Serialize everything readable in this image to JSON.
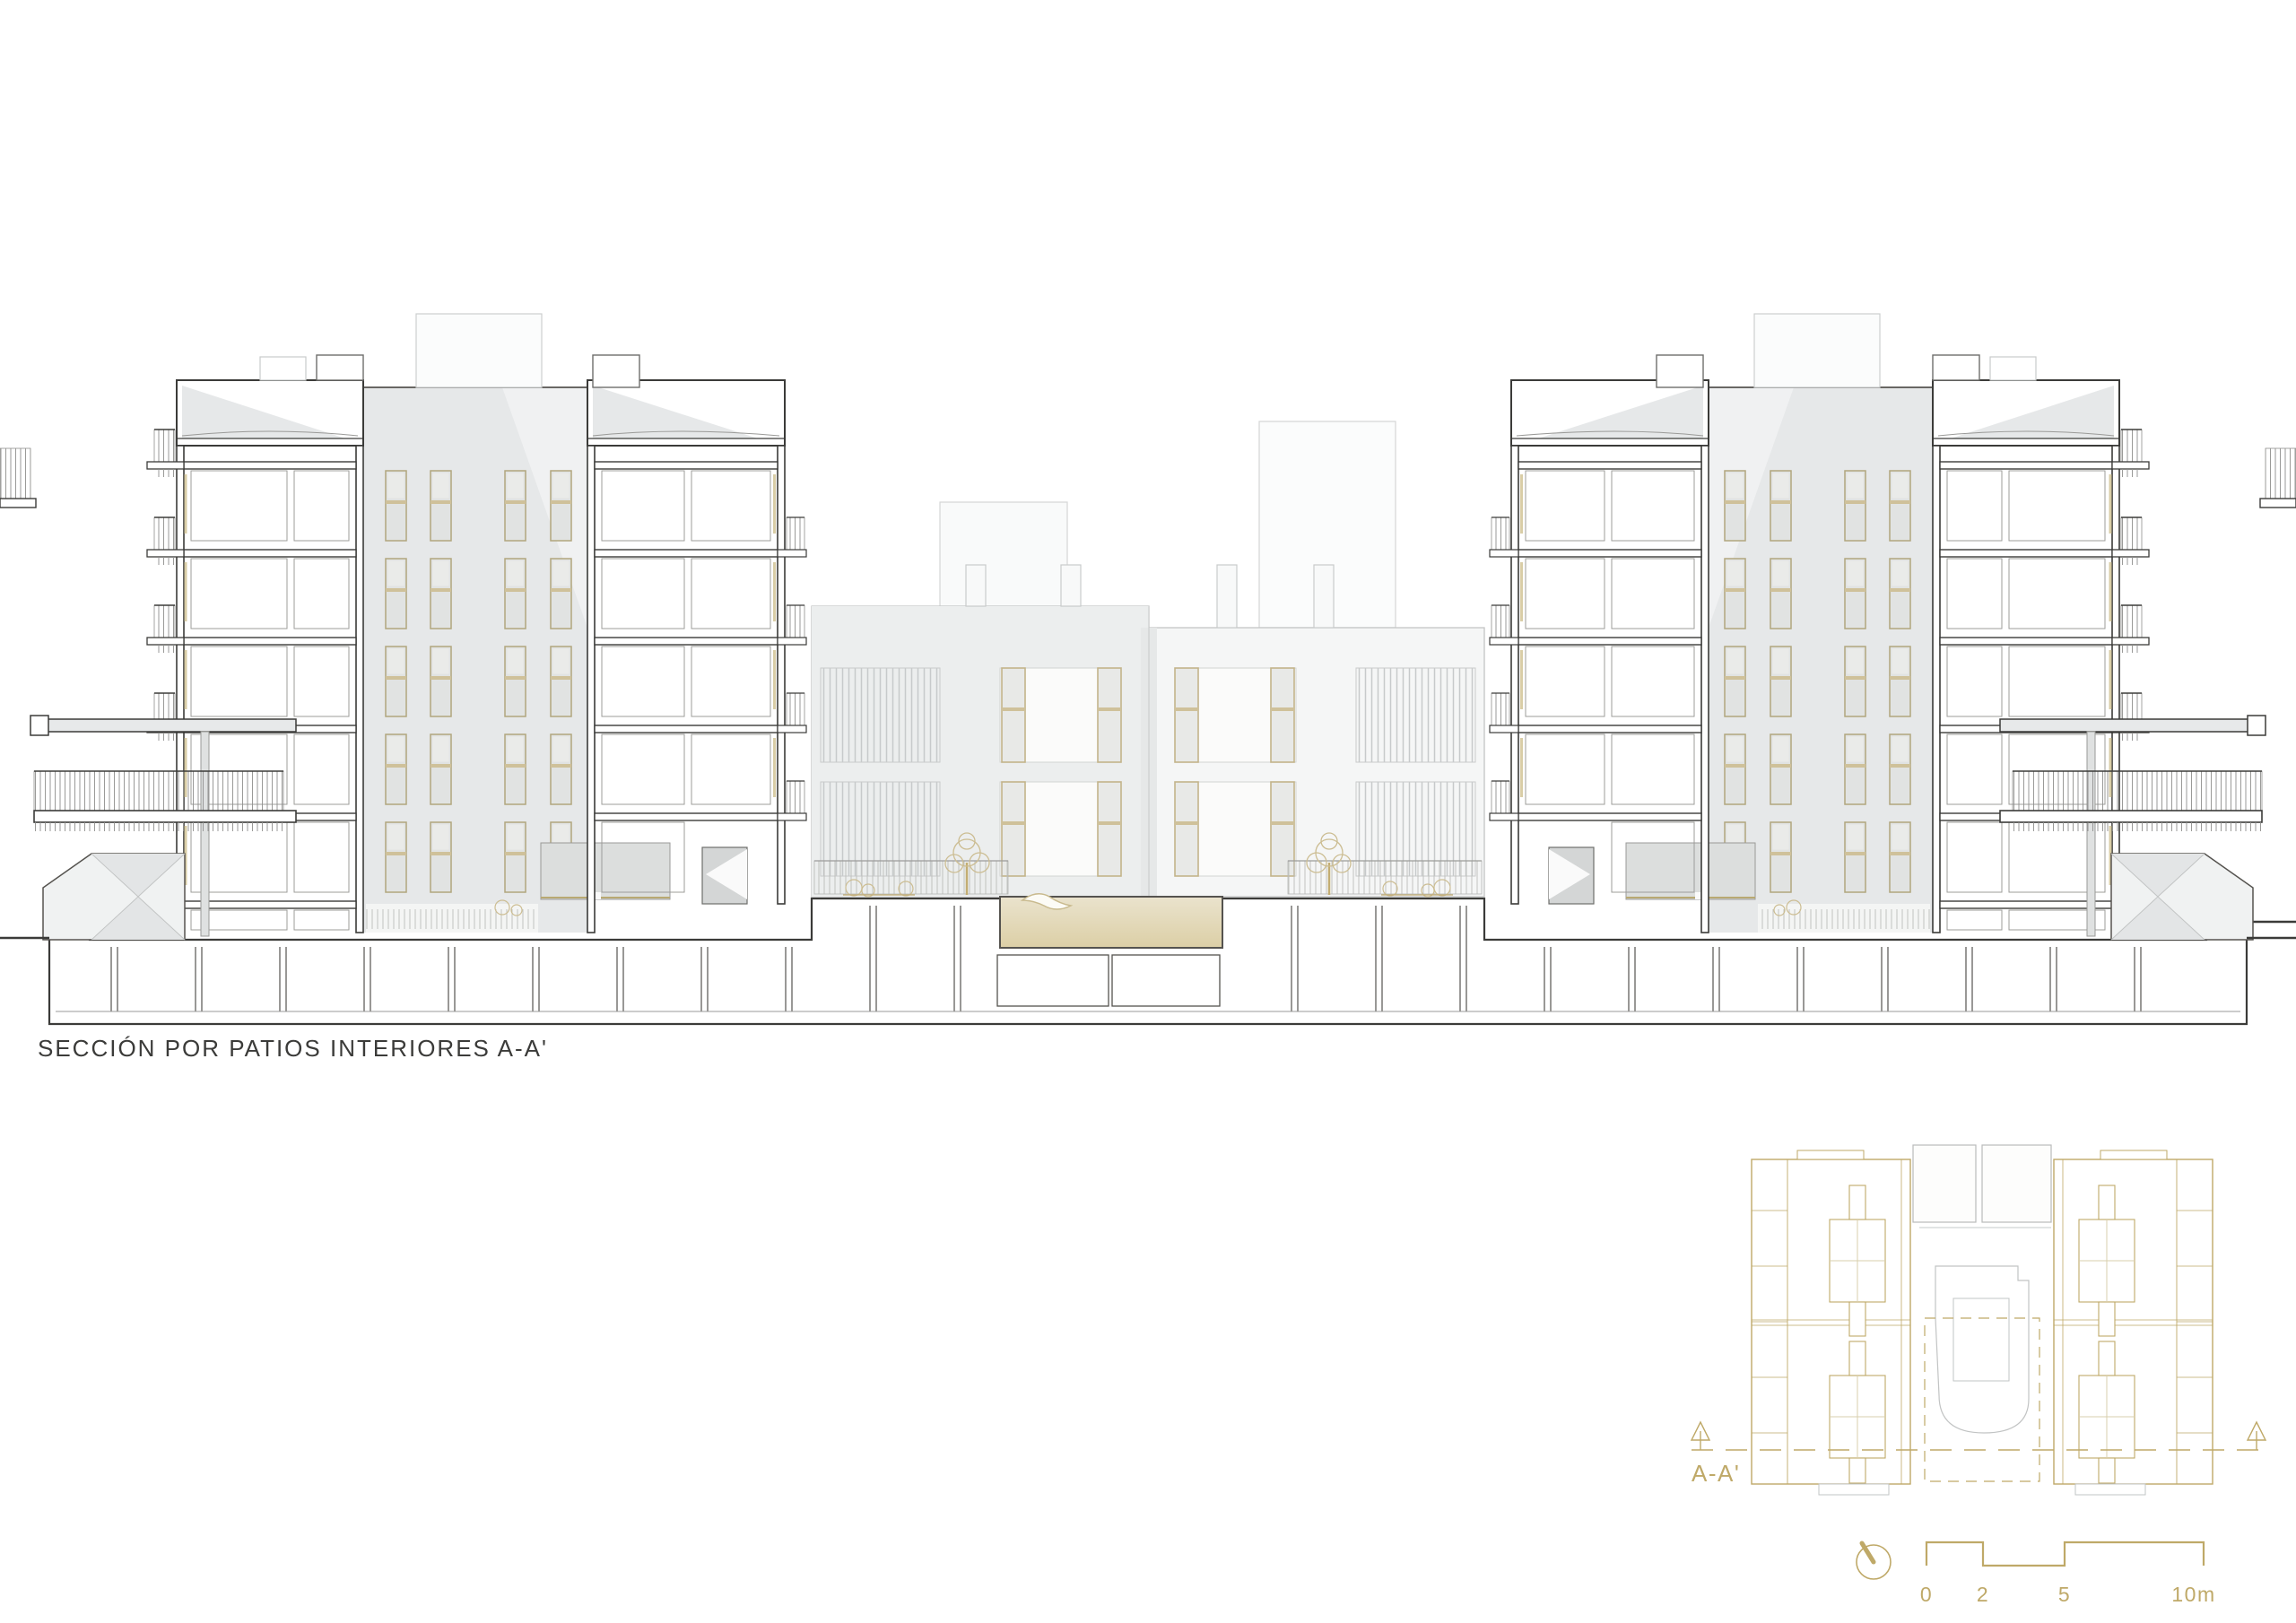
{
  "drawing": {
    "title": "SECCIÓN POR PATIOS INTERIORES A-A'",
    "kind": "architectural-section"
  },
  "key_plan": {
    "section_label": "A-A'"
  },
  "scale_bar": {
    "labels": [
      "0",
      "2",
      "5",
      "10m"
    ]
  },
  "icons": {
    "north_indicator": "north-indicator-icon",
    "section_arrows": "section-cut-arrow-icon",
    "trees": "tree-icon"
  },
  "colors": {
    "ink": "#3b3b39",
    "line_light": "#c6c8c8",
    "shadow_gray": "#e6e8e9",
    "facade_gray": "#f0f1f2",
    "glass_gray": "#e1e3e2",
    "accent_tan": "#bfa968",
    "frame_tan": "#c9ba8e",
    "pool_tan": "#ddd2ae"
  }
}
